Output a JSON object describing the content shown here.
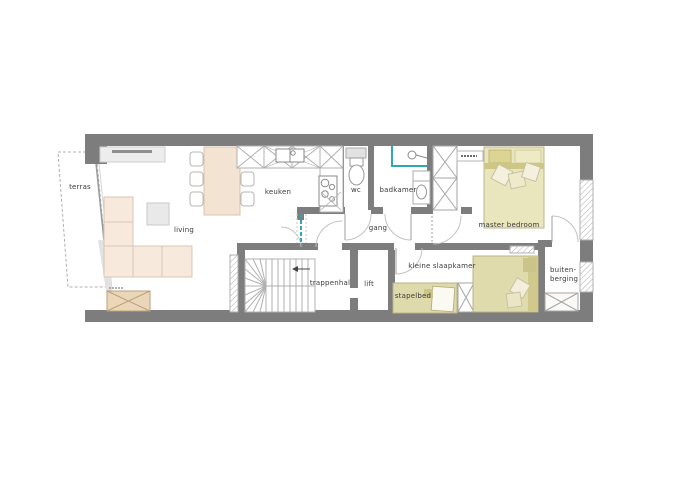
{
  "plan": {
    "type": "apartment-floorplan",
    "labels": {
      "terras": "terras",
      "living": "living",
      "keuken": "keuken",
      "wc": "wc",
      "badkamer": "badkamer",
      "gang": "gang",
      "master_bedroom": "master bedroom",
      "trappenhal": "trappenhal",
      "lift": "lift",
      "kleine_slaapkamer": "kleine slaapkamer",
      "stapelbed": "stapelbed",
      "buiten_berging_line1": "buiten-",
      "buiten_berging_line2": "berging"
    },
    "colors": {
      "wall": "#7d7d7d",
      "glass_accent": "#2fa8b5",
      "sofa_beige": "#f7e9dc",
      "wood_tan": "#ead7ba",
      "bed_khaki": "#e4e0b2",
      "thin_line": "#b0b0b0",
      "background": "#ffffff"
    }
  }
}
